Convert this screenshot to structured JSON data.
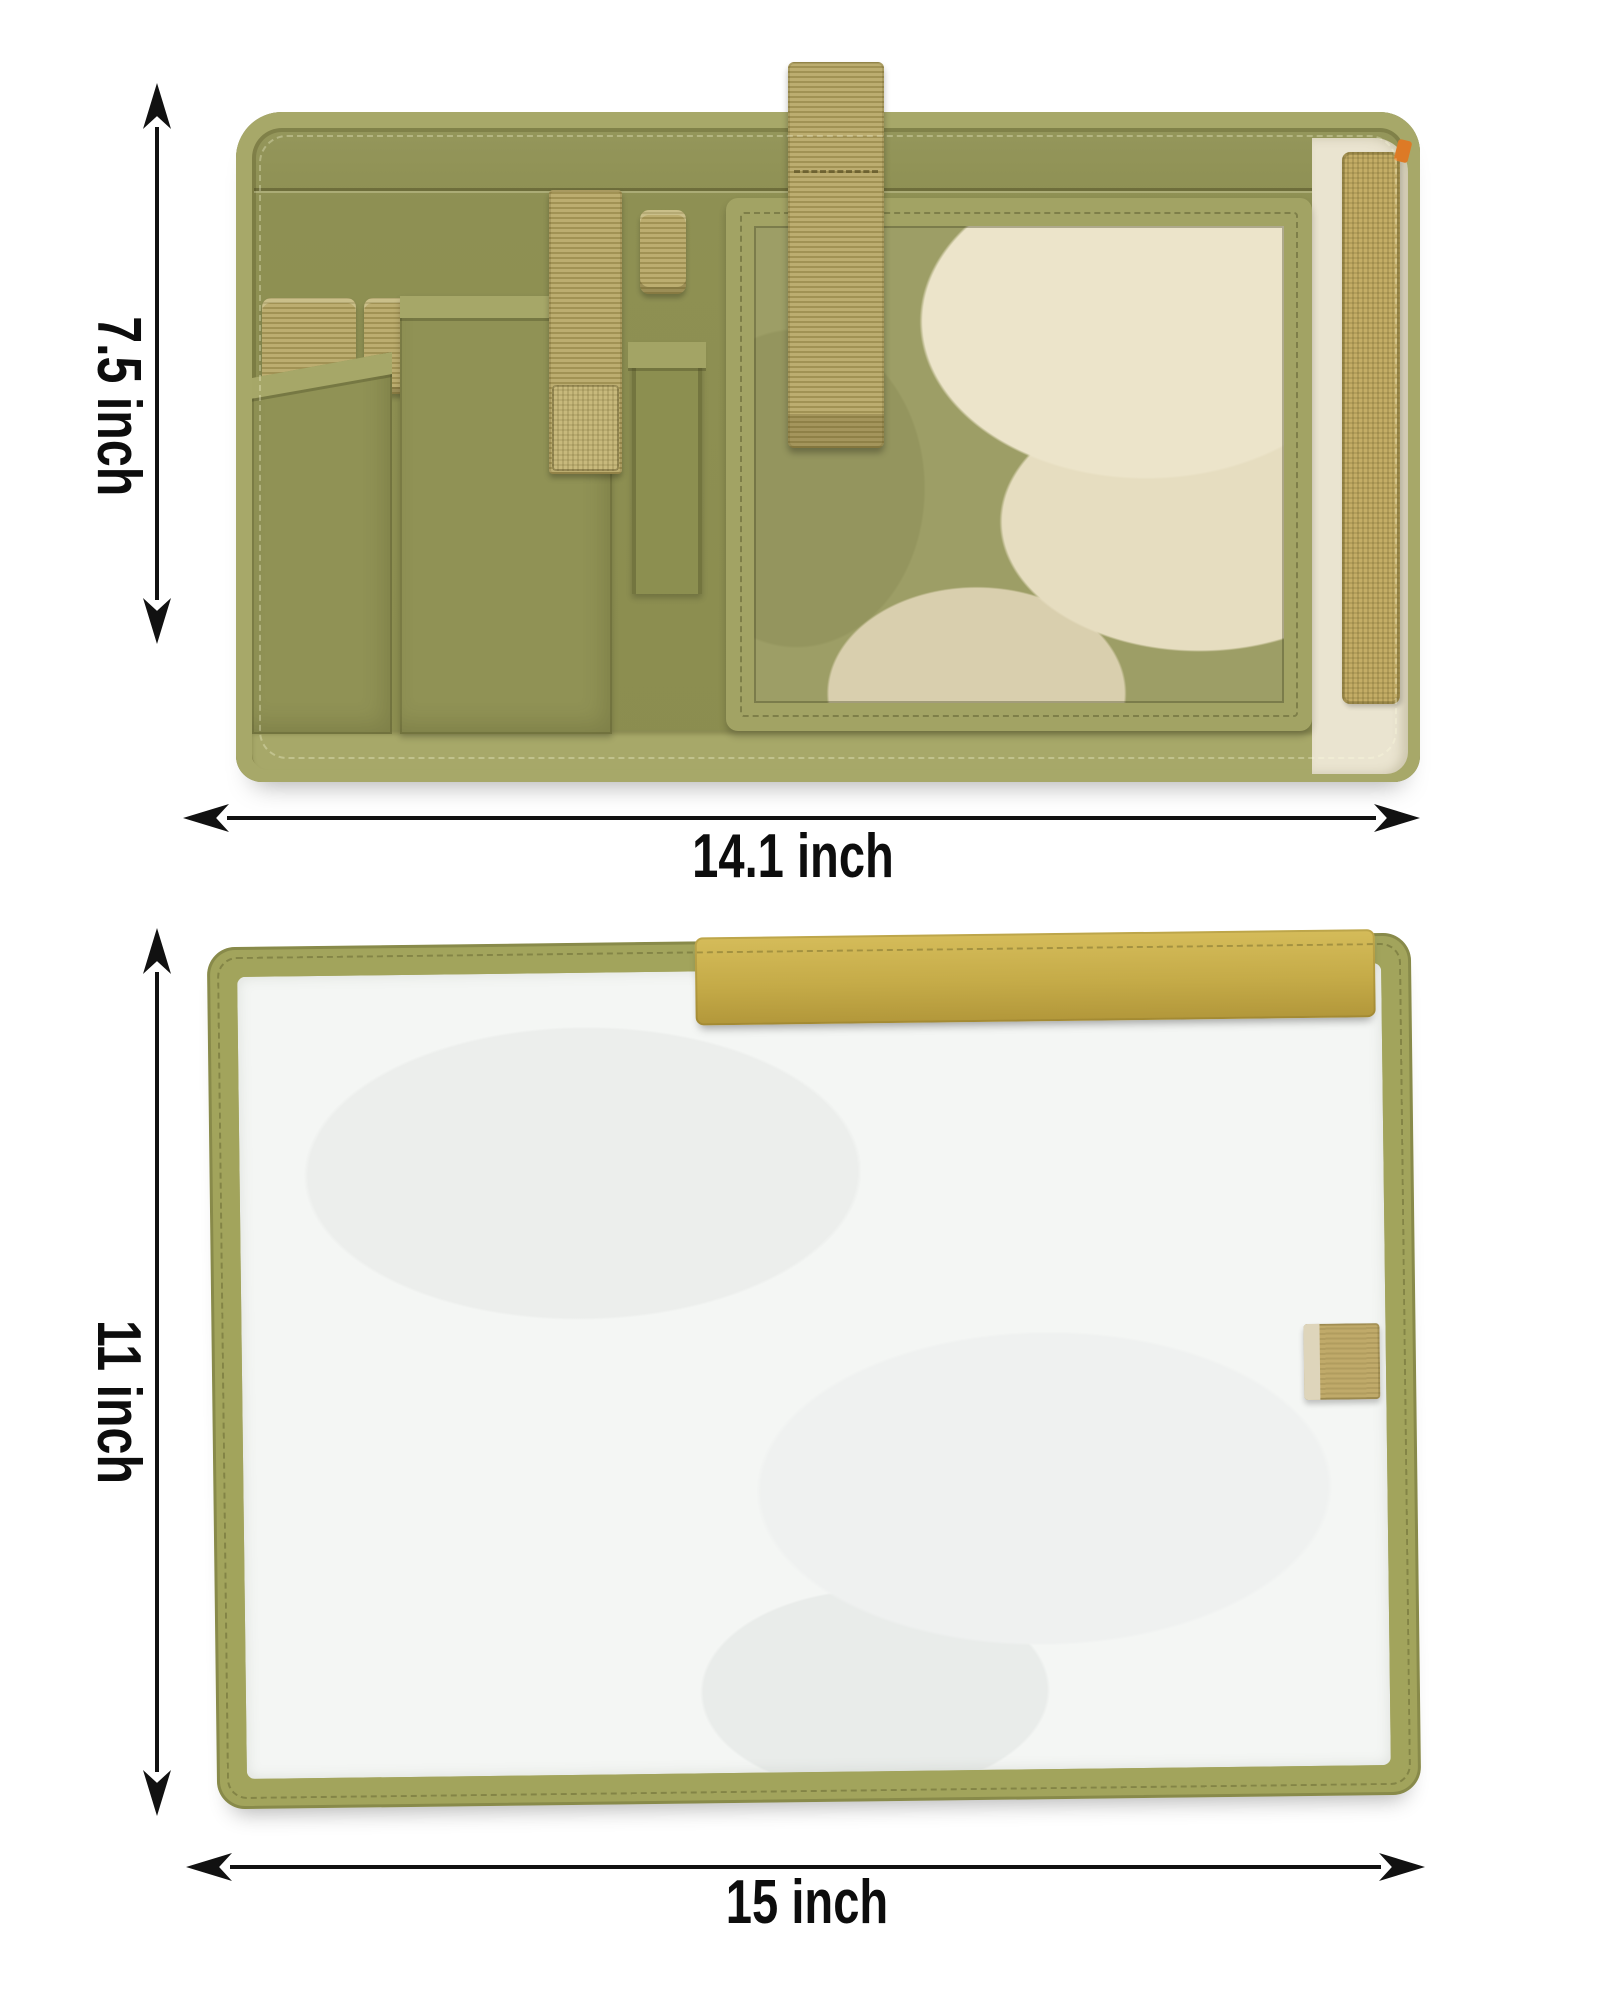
{
  "labels": {
    "top_height": "7.5 inch",
    "top_width": "14.1 inch",
    "bottom_height": "11 inch",
    "bottom_width": "15 inch"
  },
  "colors": {
    "annotation": "#111111",
    "olive_body": "#8e9052",
    "olive_binding": "#a7a869",
    "tan_webbing": "#b4a462",
    "velcro_gold": "#c9b14f",
    "cover_border": "#a2a45c",
    "cover_fill": "#f4f6f4",
    "lining_cream": "#eae4d0",
    "camo_cream": "#ece4ca",
    "background": "#ffffff"
  },
  "icons": {
    "vertical_dimension_arrow": "double-headed-arrow-vertical",
    "horizontal_dimension_arrow": "double-headed-arrow-horizontal"
  }
}
